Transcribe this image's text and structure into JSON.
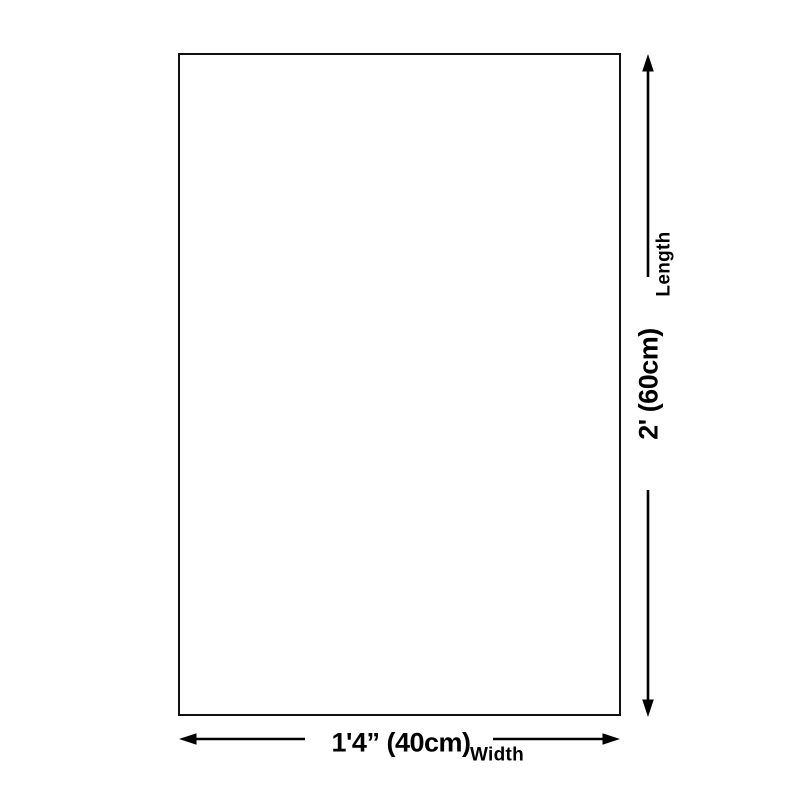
{
  "colors": {
    "background": "#ffffff",
    "line": "#000000",
    "text": "#000000"
  },
  "diagram": {
    "kind": "product-size-diagram",
    "length_dimension": {
      "axis_label": "Length",
      "value": "2' (60cm)"
    },
    "width_dimension": {
      "axis_label": "Width",
      "value": "1'4” (40cm)"
    }
  }
}
